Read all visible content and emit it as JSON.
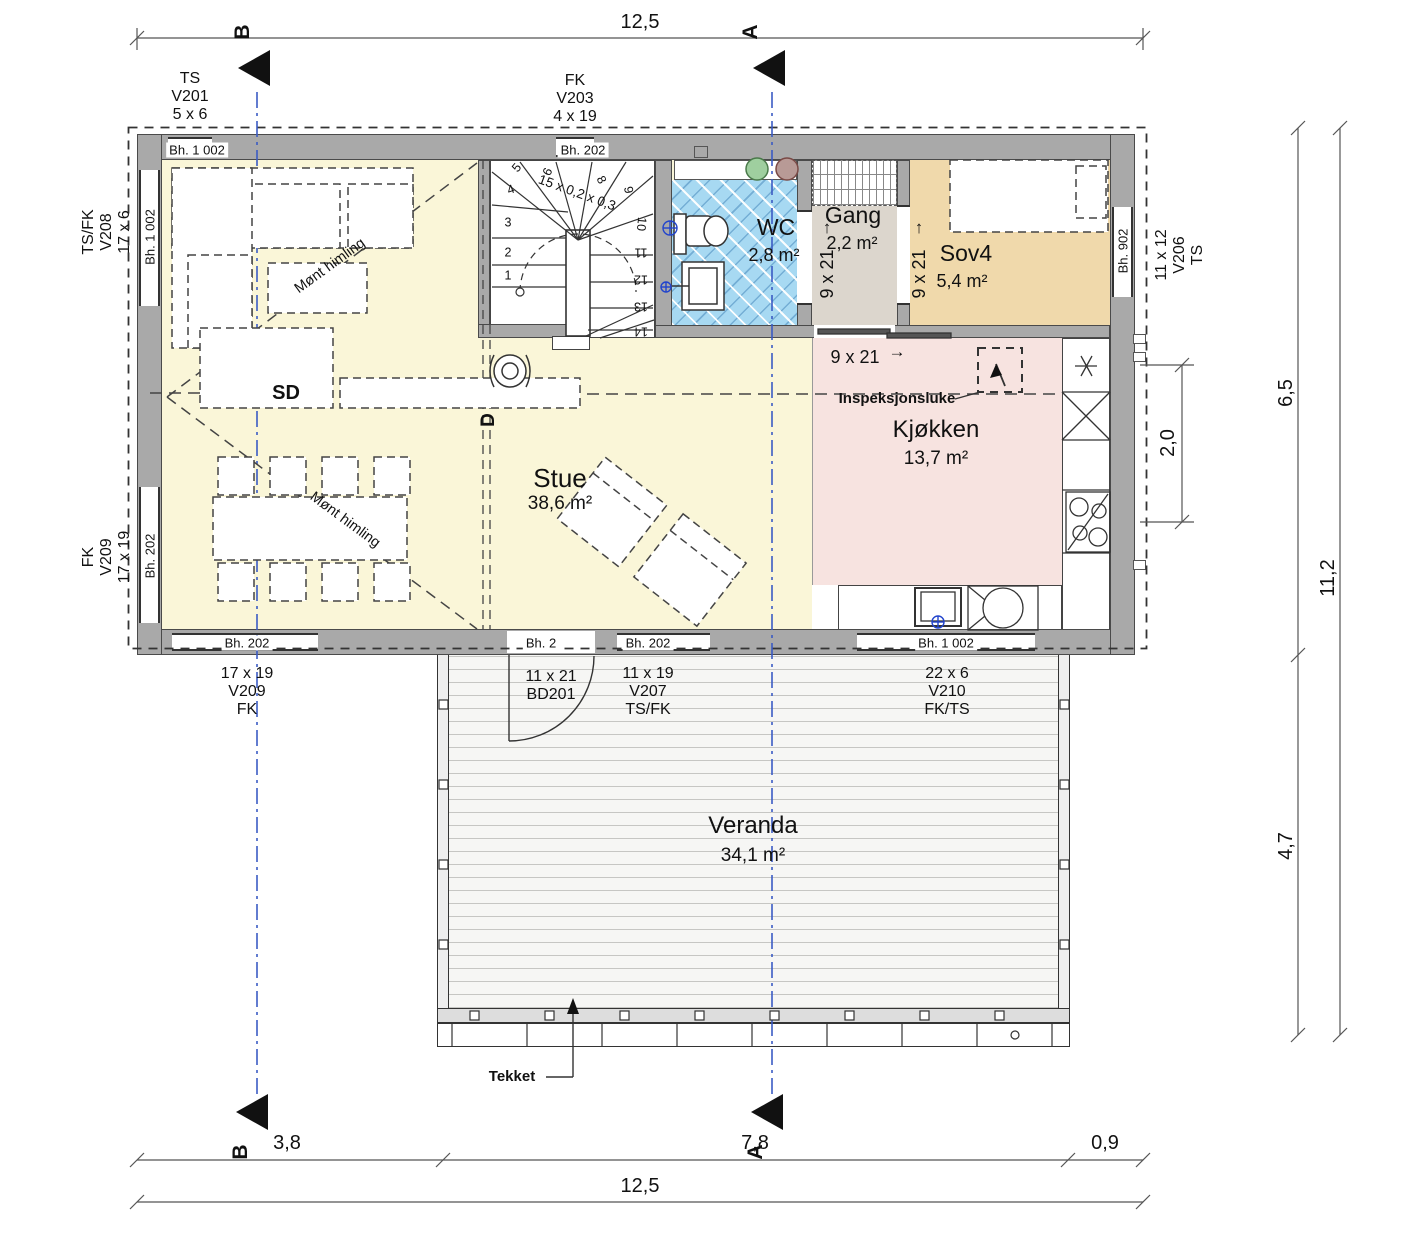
{
  "sections": {
    "b": "B",
    "a": "A",
    "d": "D",
    "sd": "SD"
  },
  "dims": {
    "top": "12,5",
    "right_upper": "6,5",
    "right_total": "11,2",
    "right_lower": "4,7",
    "kitchen_width": "2,0",
    "bottom_left": "3,8",
    "bottom_mid": "7,8",
    "bottom_right": "0,9",
    "bottom_total": "12,5"
  },
  "rooms": {
    "stue": {
      "name": "Stue",
      "area": "38,6 m²"
    },
    "kjokken": {
      "name": "Kjøkken",
      "area": "13,7 m²"
    },
    "wc": {
      "name": "WC",
      "area": "2,8 m²"
    },
    "gang": {
      "name": "Gang",
      "area": "2,2 m²"
    },
    "sov4": {
      "name": "Sov4",
      "area": "5,4 m²"
    },
    "veranda": {
      "name": "Veranda",
      "area": "34,1 m²"
    }
  },
  "windows": {
    "v201": [
      "TS",
      "V201",
      "5 x 6"
    ],
    "v203": [
      "FK",
      "V203",
      "4 x 19"
    ],
    "v208": [
      "TS/FK",
      "V208",
      "17 x 6"
    ],
    "v209_left": [
      "FK",
      "V209",
      "17 x 19"
    ],
    "v206": [
      "11 x 12",
      "V206",
      "TS"
    ],
    "v209_bottom": [
      "17 x 19",
      "V209",
      "FK"
    ],
    "bd201": [
      "11 x 21",
      "BD201"
    ],
    "v207": [
      "11 x 19",
      "V207",
      "TS/FK"
    ],
    "v210": [
      "22 x 6",
      "V210",
      "FK/TS"
    ]
  },
  "bh": {
    "top_left": "Bh. 1 002",
    "top_center": "Bh. 202",
    "left_upper": "Bh. 1 002",
    "left_lower": "Bh. 202",
    "right": "Bh. 902",
    "bottom_1": "Bh. 202",
    "bottom_2": "Bh. 2",
    "bottom_3": "Bh. 202",
    "bottom_4": "Bh. 1 002"
  },
  "doors": {
    "gang_wc": "9 x 21",
    "gang_sov4": "9 x 21",
    "kitchen": "9 x 21"
  },
  "icons": {
    "arrow_up": "↑",
    "arrow_right": "→"
  },
  "stair": {
    "spec": "15 x 0,2 x 0,3",
    "steps": [
      "1",
      "2",
      "3",
      "4",
      "5",
      "6",
      "7",
      "8",
      "9",
      "10",
      "11",
      "12",
      "13",
      "14"
    ]
  },
  "annotations": {
    "mont_himling": "Mønt himling",
    "inspeksjonsluke": "Inspeksjonsluke",
    "tekket": "Tekket"
  }
}
